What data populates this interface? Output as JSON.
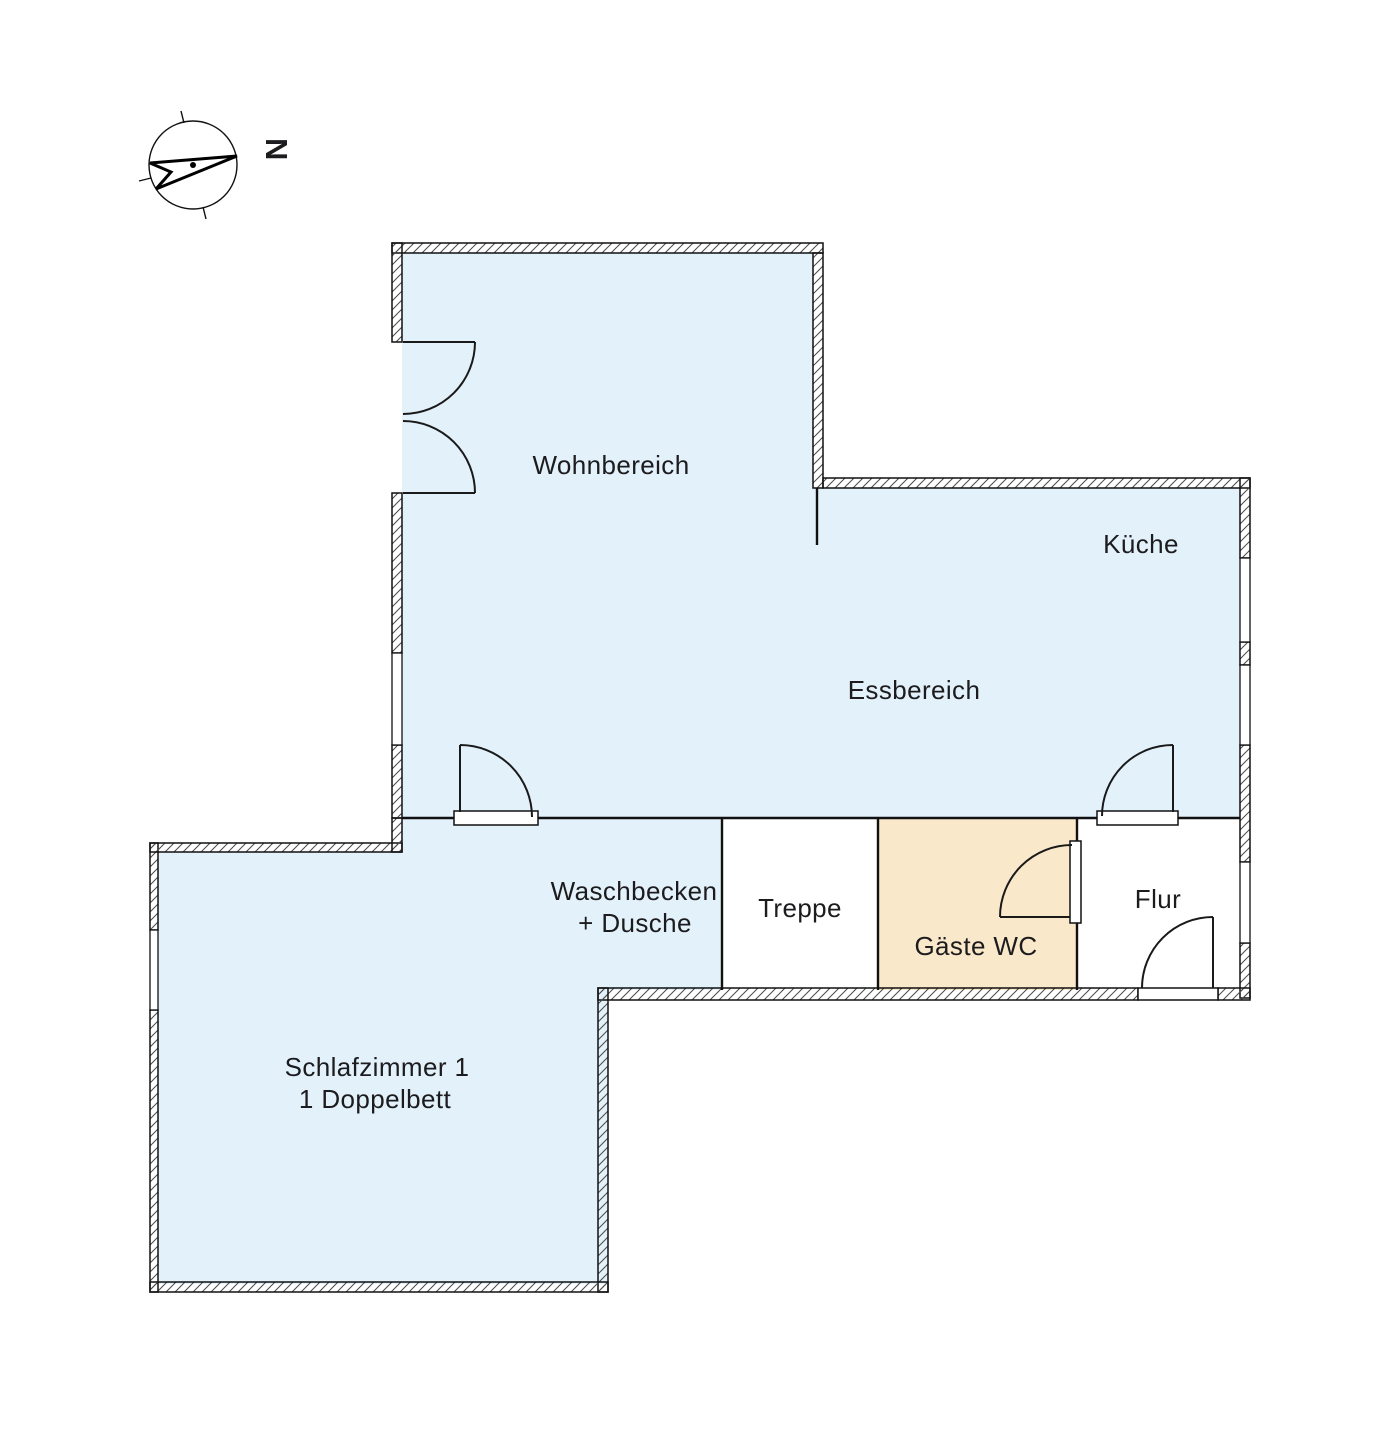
{
  "title": "Grundriss Erdgeschoss",
  "compass": {
    "north_label": "N"
  },
  "colors": {
    "room_fill": "#e3f1fa",
    "wc_fill": "#fae8ca",
    "corridor_fill": "#ffffff",
    "wall_line": "#111111",
    "hatch_line": "#4a4a4a",
    "text": "#1c1c1e"
  },
  "rooms": {
    "wohnbereich": {
      "label": "Wohnbereich"
    },
    "kueche": {
      "label": "Küche"
    },
    "essbereich": {
      "label": "Essbereich"
    },
    "waschbecken": {
      "line1": "Waschbecken",
      "line2": "+ Dusche"
    },
    "treppe": {
      "label": "Treppe"
    },
    "gaeste_wc": {
      "label": "Gäste WC"
    },
    "flur": {
      "label": "Flur"
    },
    "schlafzimmer": {
      "line1": "Schlafzimmer 1",
      "line2": "1 Doppelbett"
    }
  }
}
